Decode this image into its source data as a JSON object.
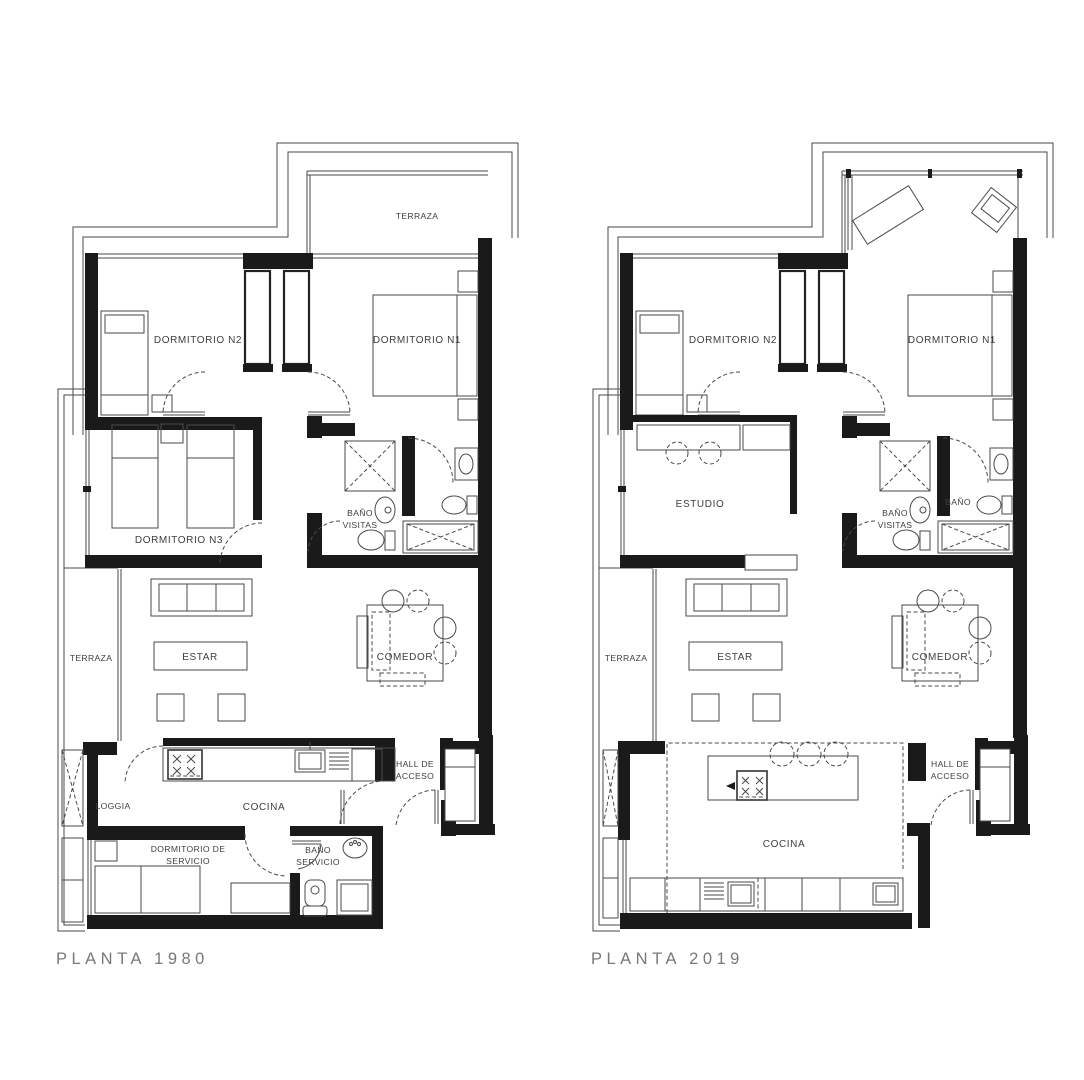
{
  "document": {
    "type": "architectural floor plan comparison",
    "background": "#ffffff",
    "wall_color": "#1a1a1a",
    "line_color": "#4a4a4a",
    "text_color": "#3e3e3e",
    "caption_color": "#787878"
  },
  "plan1980": {
    "caption": "PLANTA 1980",
    "labels": {
      "terraza_top": "TERRAZA",
      "dormitorio_n2": "DORMITORIO N2",
      "dormitorio_n1": "DORMITORIO N1",
      "dormitorio_n3": "DORMITORIO N3",
      "bano_visitas_1": "BAÑO",
      "bano_visitas_2": "VISITAS",
      "terraza_left": "TERRAZA",
      "estar": "ESTAR",
      "comedor": "COMEDOR",
      "loggia": "LOGGIA",
      "cocina": "COCINA",
      "hall_1": "HALL DE",
      "hall_2": "ACCESO",
      "dorm_servicio_1": "DORMITORIO DE",
      "dorm_servicio_2": "SERVICIO",
      "bano_servicio_1": "BAÑO",
      "bano_servicio_2": "SERVICIO"
    }
  },
  "plan2019": {
    "caption": "PLANTA 2019",
    "labels": {
      "dormitorio_n2": "DORMITORIO N2",
      "dormitorio_n1": "DORMITORIO N1",
      "estudio": "ESTUDIO",
      "bano_visitas_1": "BAÑO",
      "bano_visitas_2": "VISITAS",
      "bano": "BAÑO",
      "terraza_left": "TERRAZA",
      "estar": "ESTAR",
      "comedor": "COMEDOR",
      "cocina": "COCINA",
      "hall_1": "HALL DE",
      "hall_2": "ACCESO"
    }
  }
}
